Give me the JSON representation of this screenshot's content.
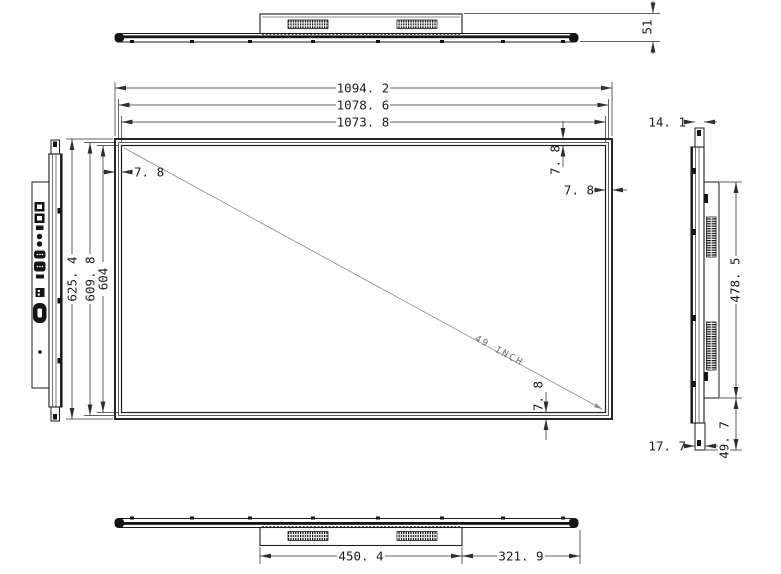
{
  "drawing": {
    "type": "technical-drawing",
    "subject": "49 inch display panel outline drawing",
    "labels": {
      "width_outer": "1094. 2",
      "width_mid": "1078. 6",
      "width_active": "1073. 8",
      "height_outer": "625. 4",
      "height_mid": "609. 8",
      "height_active": "604",
      "bezel_top_left": "7. 8",
      "bezel_top_right": "7. 8",
      "bezel_right": "7. 8",
      "bezel_bottom": "7. 8",
      "top_view_thickness": "51",
      "side_top_thickness": "14. 1",
      "back_housing_height": "478. 5",
      "housing_to_bottom": "49. 7",
      "side_bottom_thickness": "17. 7",
      "bottom_housing_width": "450. 4",
      "housing_to_right_edge": "321. 9",
      "diagonal": "49 INCH"
    },
    "colors": {
      "outline": "#1b1b1b",
      "dimension": "#2e2e2e",
      "diagonal_line": "#8a8a8a",
      "background": "#ffffff"
    }
  }
}
